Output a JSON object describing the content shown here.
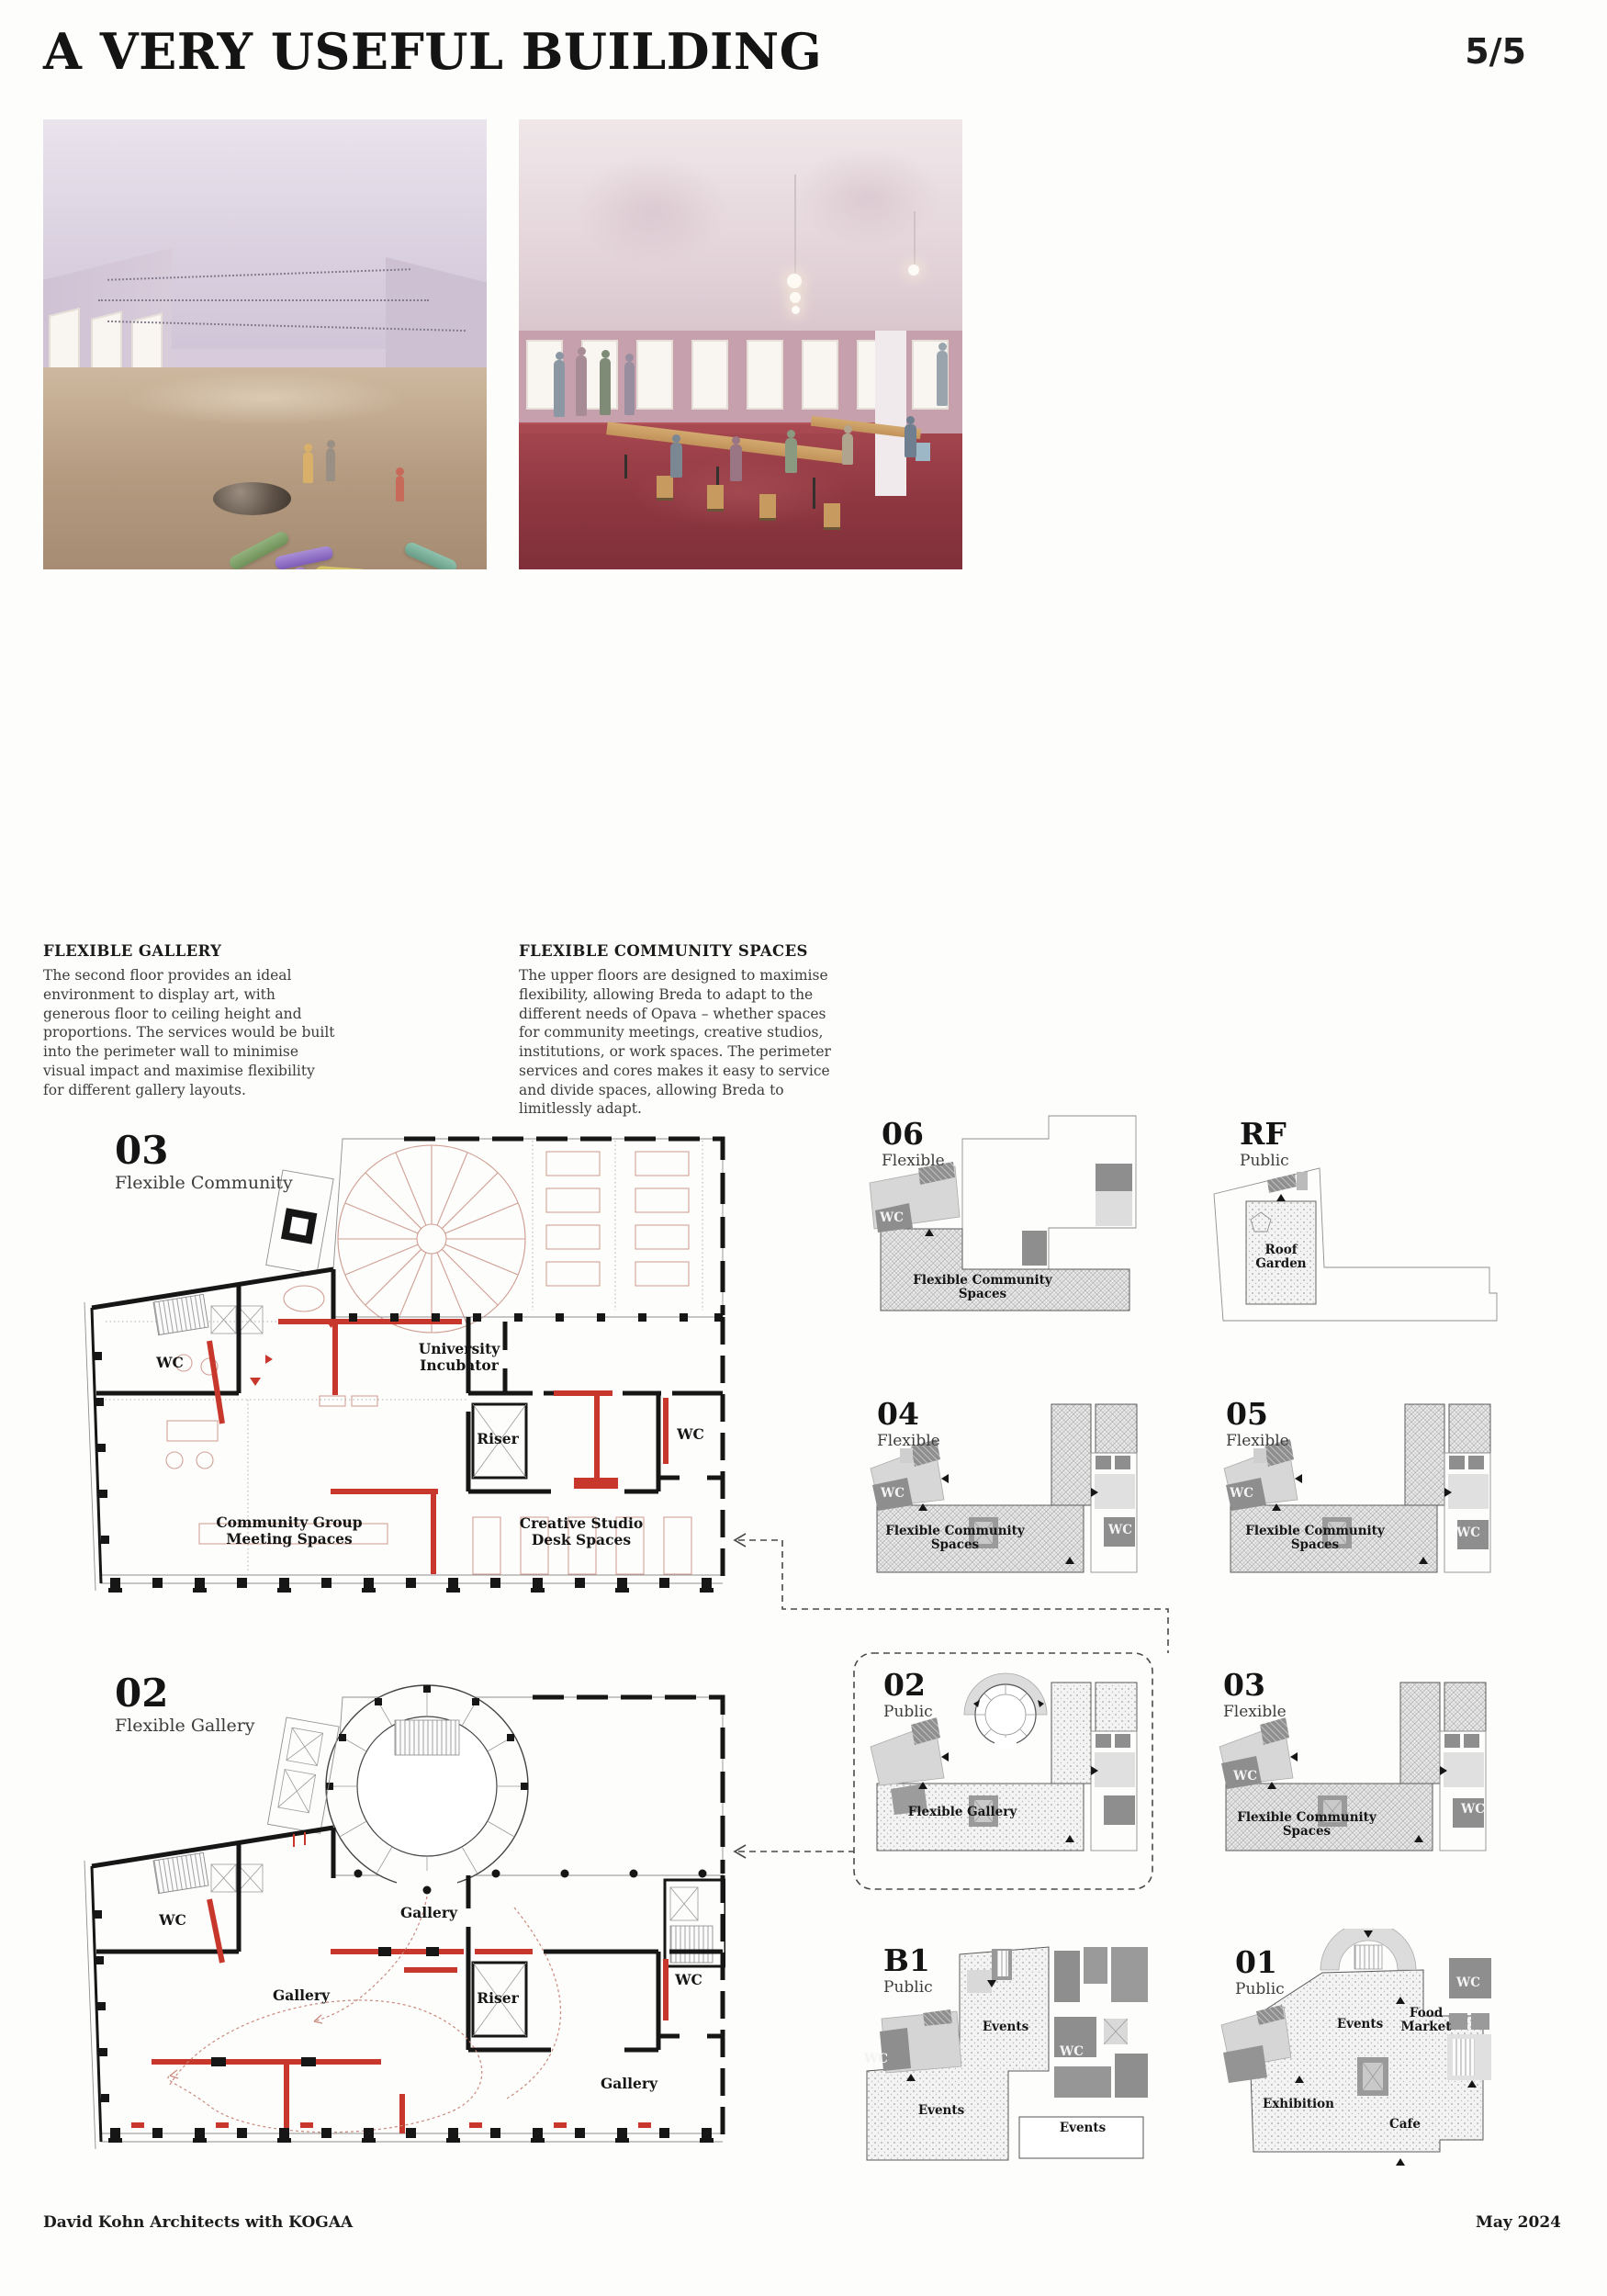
{
  "page": {
    "title": "A VERY USEFUL BUILDING",
    "page_number": "5/5",
    "footer_left": "David Kohn Architects with KOGAA",
    "footer_right": "May 2024"
  },
  "captions": {
    "gallery": {
      "heading": "FLEXIBLE GALLERY",
      "body": "The second floor provides an ideal environment to display art, with generous floor to ceiling height and proportions. The services would be built into the perimeter wall to minimise visual impact and maximise flexibility for different gallery layouts."
    },
    "community": {
      "heading": "FLEXIBLE COMMUNITY SPACES",
      "body": "The upper floors are designed to maximise flexibility, allowing Breda to adapt to the different needs of Opava – whether spaces for community meetings, creative studios, institutions, or work spaces. The perimeter services and cores makes it easy to service and divide spaces, allowing Breda to limitlessly adapt."
    }
  },
  "plans": {
    "large_03": {
      "number": "03",
      "name": "Flexible Community",
      "labels": {
        "wc_left": "WC",
        "incubator": "University Incubator",
        "riser": "Riser",
        "wc_right": "WC",
        "meeting": "Community Group Meeting Spaces",
        "studio": "Creative Studio Desk Spaces"
      }
    },
    "large_02": {
      "number": "02",
      "name": "Flexible Gallery",
      "labels": {
        "wc_left": "WC",
        "gallery_mid": "Gallery",
        "gallery_left": "Gallery",
        "gallery_bottom": "Gallery",
        "riser": "Riser",
        "wc_right": "WC"
      }
    },
    "small_06": {
      "number": "06",
      "name": "Flexible",
      "labels": {
        "wc": "WC",
        "area": "Flexible Community Spaces"
      }
    },
    "small_rf": {
      "number": "RF",
      "name": "Public",
      "labels": {
        "area": "Roof Garden"
      }
    },
    "small_04": {
      "number": "04",
      "name": "Flexible",
      "labels": {
        "wc_left": "WC",
        "wc_right": "WC",
        "area": "Flexible Community Spaces"
      }
    },
    "small_05": {
      "number": "05",
      "name": "Flexible",
      "labels": {
        "wc_left": "WC",
        "wc_right": "WC",
        "area": "Flexible Community Spaces"
      }
    },
    "small_02": {
      "number": "02",
      "name": "Public",
      "labels": {
        "area": "Flexible Gallery"
      }
    },
    "small_03": {
      "number": "03",
      "name": "Flexible",
      "labels": {
        "wc_left": "WC",
        "wc_right": "WC",
        "area": "Flexible Community Spaces"
      }
    },
    "small_b1": {
      "number": "B1",
      "name": "Public",
      "labels": {
        "events_top": "Events",
        "events_left": "Events",
        "events_right": "Events",
        "wc_left": "WC",
        "wc_right": "WC"
      }
    },
    "small_01": {
      "number": "01",
      "name": "Public",
      "labels": {
        "events": "Events",
        "food_market": "Food Market",
        "exhibition": "Exhibition",
        "cafe": "Cafe",
        "wc": "WC"
      }
    }
  },
  "colors": {
    "accent_red": "#c8372b",
    "pale_red": "#d2a096",
    "plan_black": "#161616",
    "dark_gray": "#8e8e8e"
  }
}
